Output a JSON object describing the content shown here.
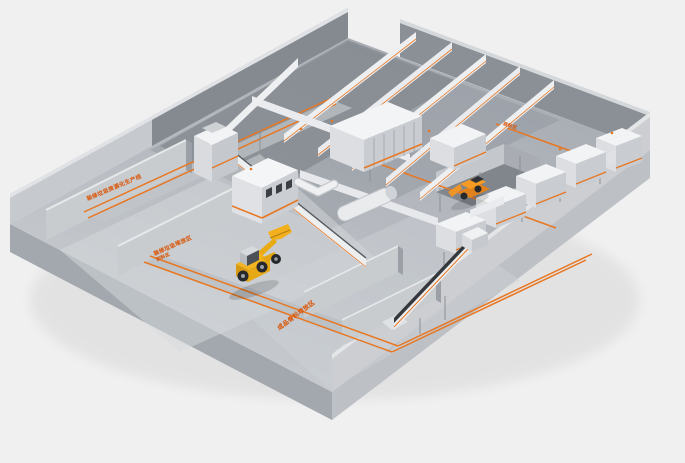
{
  "floor_labels": {
    "aisle_left": "装修垃圾资源化生产线",
    "bay_left_line1": "装修垃圾堆放区",
    "bay_left_line2": "卸料区",
    "bay_bottom": "成品骨料堆放区",
    "wall_right": "进料区"
  },
  "objects": {
    "vehicle_center": "wheel-loader",
    "vehicle_right": "material-handler"
  },
  "colors": {
    "background": "#f0f0f1",
    "floor_top": "#b9bdc2",
    "floor_light": "#d6d9dc",
    "slab_side": "#a3a8ae",
    "wall_light": "#ccced2",
    "wall_dark": "#8b9097",
    "back_wall": "#858a91",
    "accent_orange": "#e87722",
    "label_orange": "#d95d15",
    "machine_white": "#f3f4f6",
    "belt_dark": "#34383c",
    "loader_yellow": "#f4b41f",
    "handler_orange": "#ef9426"
  }
}
